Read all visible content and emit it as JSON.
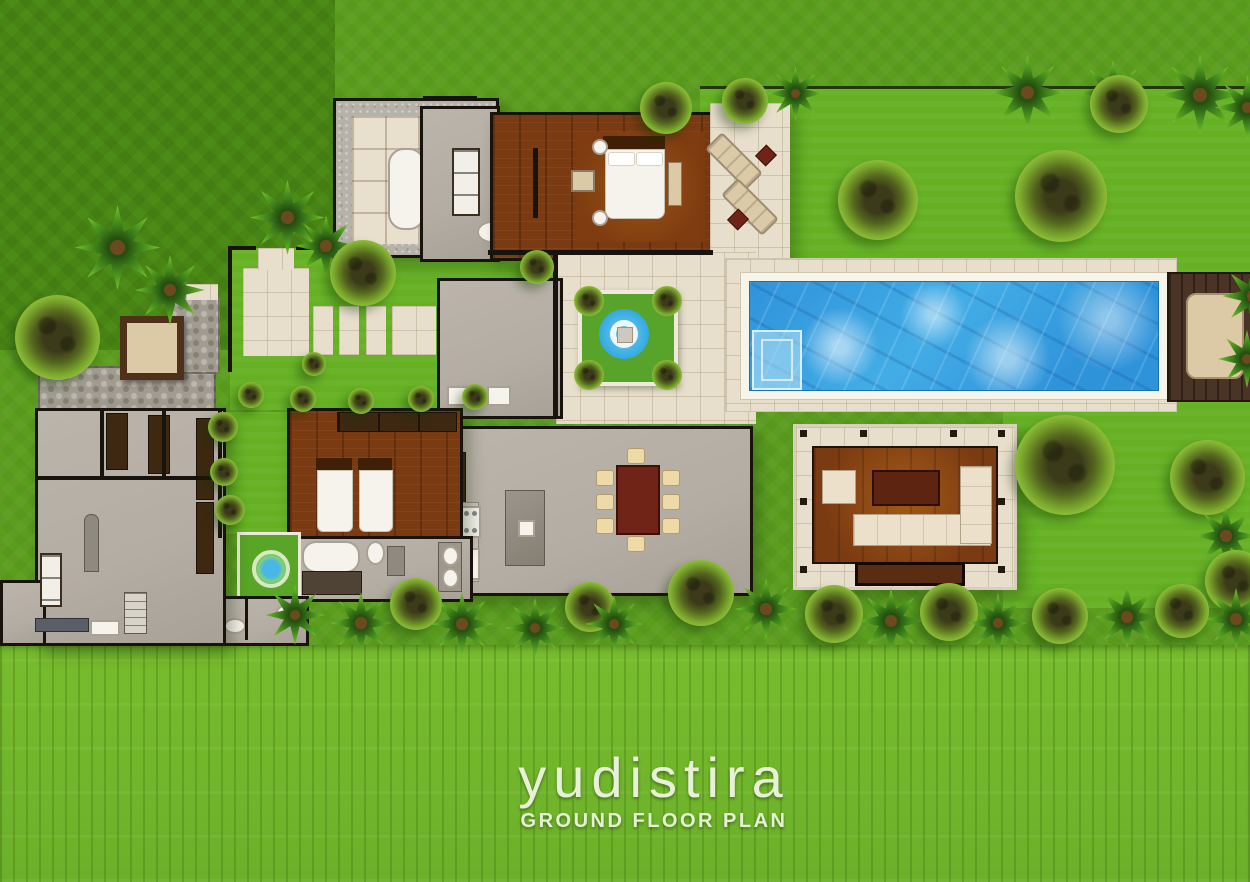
{
  "logo": {
    "title": "yudistira",
    "subtitle": "GROUND FLOOR PLAN"
  },
  "palette": {
    "lawn": "#5b9e1e",
    "lawn-dark": "#4c8c16",
    "lawn-bright": "#65b123",
    "rice": "#78bc2e",
    "stone": "#e8decc",
    "granite": "#b7b2a9",
    "grey": "#b4ada3",
    "wood": "#7a3a12",
    "wood-dark": "#4a3425",
    "wall": "#18130c",
    "pool": "#2f93da",
    "pool-light": "#74cdf0",
    "cream": "#dcc9a6",
    "sofa": "#ece0cb",
    "maroon": "#702418",
    "furn-dark": "#3e2812",
    "fixture": "#f6f3ec",
    "logo": "#edf4df"
  },
  "legend": {
    "areas": [
      "master bathroom",
      "master bedroom",
      "sun terrace",
      "entry garden",
      "courtyard water feature",
      "swimming pool",
      "pool wood deck",
      "living pavilion",
      "dining room",
      "kitchen",
      "guest bedroom",
      "guest bathroom",
      "service wing",
      "rice field"
    ]
  }
}
